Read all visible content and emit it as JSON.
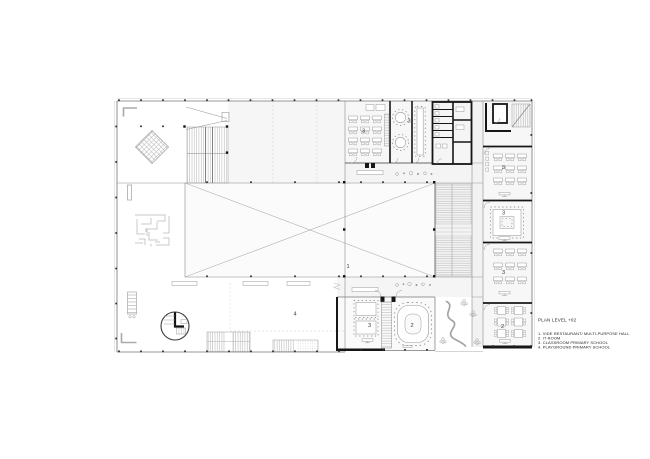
{
  "legend": {
    "title": "PLAN LEVEL +02",
    "items": [
      "1. VIDE RESTAURANT/ MULTI-PURPOSE HALL",
      "2. IT ROOM",
      "3. CLASSROOM PRIMARY SCHOOL",
      "4. PLAYGROUND PRIMARY SCHOOL"
    ]
  },
  "room_labels": {
    "multi_purpose_hall": "1",
    "it_room": "2",
    "it_room_right_wing": "2",
    "classroom_top": "3",
    "classroom_top_round_tables": "3",
    "classroom_right_a": "3",
    "classroom_right_b": "3",
    "classroom_right_c": "3",
    "classroom_bottom": "3",
    "playground": "4"
  },
  "colors": {
    "background": "#ffffff",
    "wall_heavy": "#161616",
    "wall_light": "#8a8a8a",
    "hatch": "#b3b3b3",
    "text": "#2e2e2e"
  }
}
